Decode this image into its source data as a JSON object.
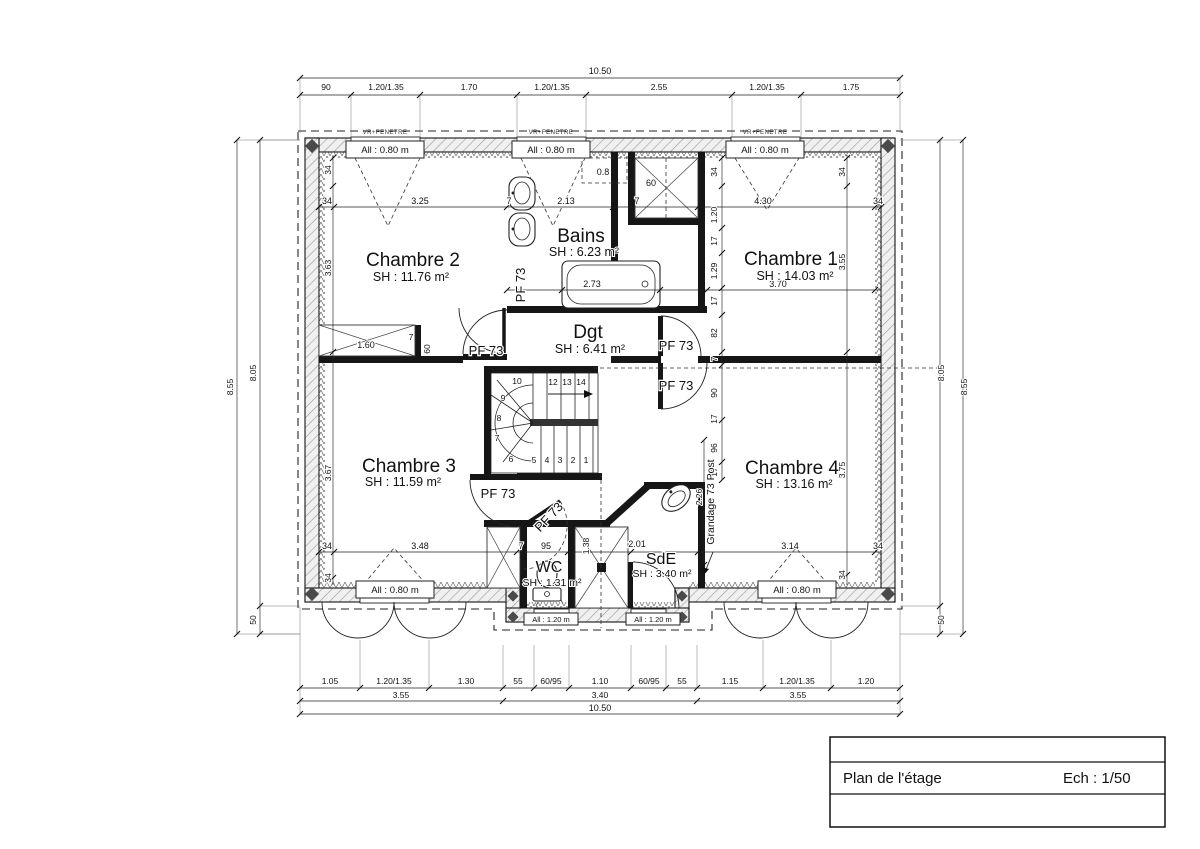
{
  "title_block": {
    "title": "Plan de l'étage",
    "scale": "Ech : 1/50"
  },
  "rooms": {
    "chambre1": {
      "name": "Chambre 1",
      "area": "SH : 14.03 m²"
    },
    "chambre2": {
      "name": "Chambre 2",
      "area": "SH : 11.76 m²"
    },
    "chambre3": {
      "name": "Chambre 3",
      "area": "SH : 11.59 m²"
    },
    "chambre4": {
      "name": "Chambre 4",
      "area": "SH : 13.16 m²"
    },
    "bains": {
      "name": "Bains",
      "area": "SH : 6.23 m²"
    },
    "dgt": {
      "name": "Dgt",
      "area": "SH : 6.41 m²"
    },
    "wc": {
      "name": "WC",
      "area": "SH : 1.31 m²"
    },
    "sde": {
      "name": "SdE",
      "area": "SH : 3.40 m²"
    }
  },
  "labels": {
    "door": "PF 73",
    "post": "Grandage 73 Post",
    "window_blind": "VR+FENETRE",
    "window_h080": "All : 0.80 m",
    "window_h120": "All : 1.20 m",
    "alcove": "0.8"
  },
  "dims": {
    "top_total": "10.50",
    "top_segments": [
      "90",
      "1.20/1.35",
      "1.70",
      "1.20/1.35",
      "2.55",
      "1.20/1.35",
      "1.75"
    ],
    "bottom_segments": [
      "1.05",
      "1.20/1.35",
      "1.30",
      "55",
      "60/95",
      "1.10",
      "60/95",
      "55",
      "1.15",
      "1.20/1.35",
      "1.20"
    ],
    "bottom_row2": [
      "3.55",
      "3.40",
      "3.55"
    ],
    "bottom_total": "10.50",
    "left_total": "8.55",
    "left_main": "8.05",
    "left_bump": "50",
    "right_total": "8.55",
    "right_main": "8.05",
    "right_bump": "50",
    "chain_top": [
      "34",
      "3.25",
      "7",
      "2.13",
      "7",
      "60",
      "4.30",
      "34"
    ],
    "chain_mid": [
      "2.73",
      "3.70"
    ],
    "chain_bottom": [
      "34",
      "3.48",
      "7",
      "95",
      "2.01",
      "3.14",
      "34"
    ],
    "chain_center": [
      "34",
      "1.20",
      "17",
      "1.29",
      "17",
      "82",
      "7",
      "90",
      "17",
      "96",
      "17"
    ],
    "chain_left": [
      "34",
      "3.63",
      "3.67",
      "34"
    ],
    "chain_right": [
      "34",
      "3.55",
      "3.75",
      "34"
    ],
    "closet": [
      "1.60",
      "60",
      "7"
    ],
    "closet_top": "60",
    "shower_w": "1.38",
    "post_h": "2.26"
  },
  "stairs": [
    "1",
    "2",
    "3",
    "4",
    "5",
    "6",
    "7",
    "8",
    "9",
    "10",
    "12",
    "13",
    "14"
  ]
}
